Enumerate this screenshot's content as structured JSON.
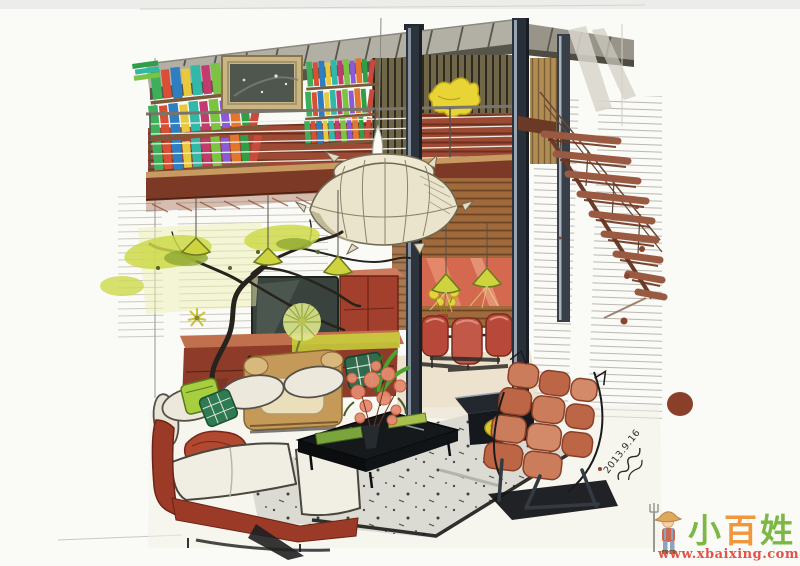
{
  "watermark": {
    "brand": "小百姓",
    "chars": [
      "小",
      "百",
      "姓"
    ],
    "url": "www.xbaixing.com",
    "mascot_icon": "farmer-with-pitchfork",
    "colors": {
      "char1": "#7cb843",
      "char2": "#f0963c",
      "char3": "#7cb843",
      "url": "#e2534a"
    }
  },
  "signature": {
    "date": "2013.9.16"
  },
  "palette": {
    "paper": "#fafaf7",
    "ceiling_gray": "#b2afa4",
    "wood_red_slats": "#9c4a33",
    "mezzanine_fascia": "#7c3a26",
    "steel_column": "#2d333d",
    "lantern_cream": "#eae4cd",
    "accent_yellow_green": "#cdd94a",
    "orange_wall": "#d4694f",
    "sofa_base_red": "#9c3a28",
    "lounge_chair_coral": "#c97a58",
    "tan_armchair": "#c59a58",
    "ink": "#1c1c1c",
    "splatter_brown": "#8a4530"
  }
}
